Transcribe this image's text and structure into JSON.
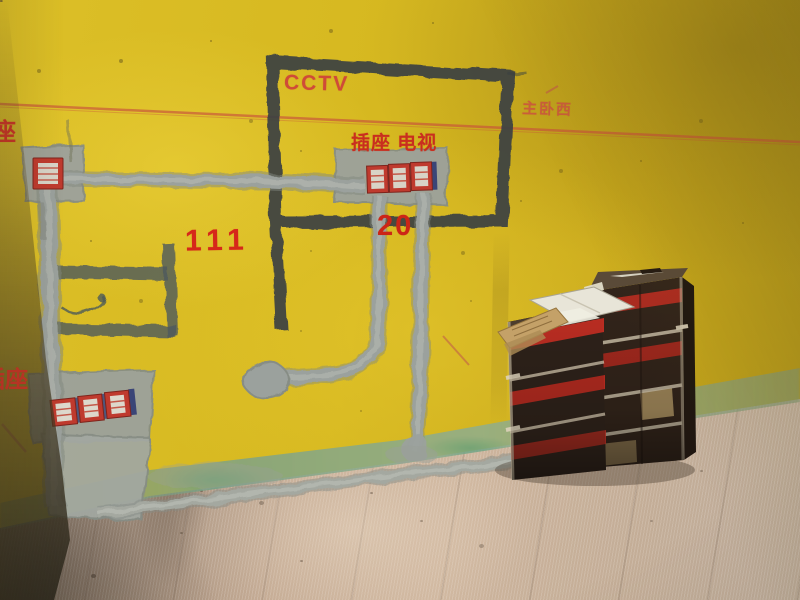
{
  "wall_markings": {
    "cctv": "CCTV",
    "socket_tv": "插座 电视",
    "room_name": "主卧西",
    "circuit_number_left": "111",
    "circuit_number_right": "20",
    "socket_label_lower_left": "插座",
    "socket_label_upper_left_partial": "座"
  },
  "colors": {
    "wall_yellow": "#d6b820",
    "marking_red": "#cc2a1d",
    "chalk_line_red": "#c8503c",
    "dark_outline": "#3a4042",
    "groove_gray": "#4e585c",
    "conduit_gray": "#9ba19d",
    "socket_box_red": "#bf3a2e",
    "socket_box_blue": "#3a4577",
    "skirting_green": "#7fa387",
    "floor_tan": "#c2a891",
    "carton_brown": "#33251b",
    "carton_stripe_red": "#bb2d22",
    "carton_edge_cream": "#cfc3aa",
    "flap_white": "#e8e5d8",
    "cardboard_tan": "#c4a168"
  }
}
